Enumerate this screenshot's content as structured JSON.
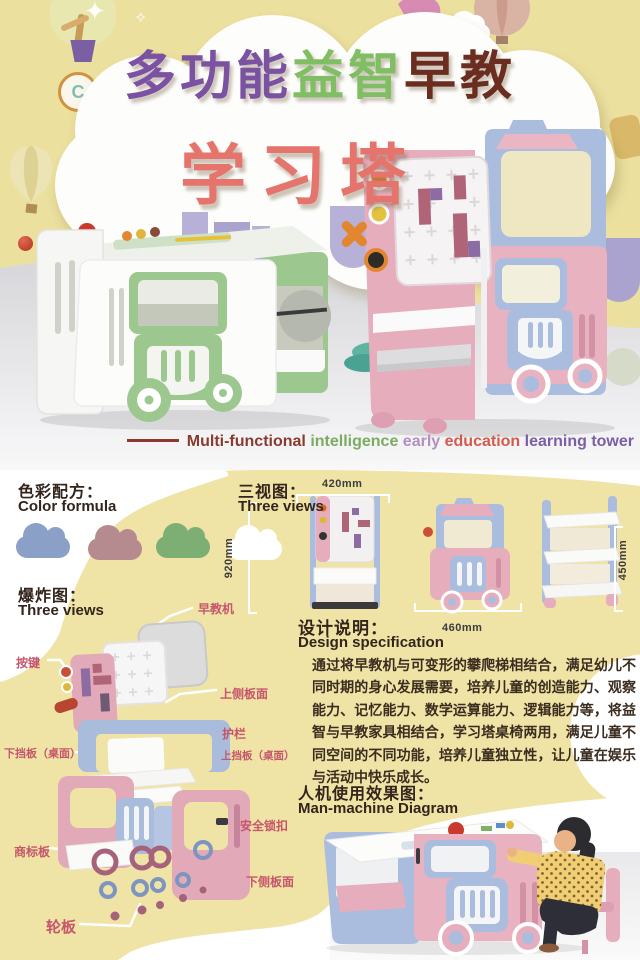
{
  "poster": {
    "title": {
      "seg1": "多功能",
      "seg2": "益智",
      "seg3": "早教",
      "line2": "学习塔"
    },
    "subtitle": {
      "seg1": "Multi-functional",
      "seg2": "intelligence",
      "seg3": "early",
      "seg4": "education",
      "seg5": "learning tower"
    },
    "badges": {
      "c": "C",
      "r": "R"
    }
  },
  "color_formula": {
    "heading_zh": "色彩配方：",
    "heading_en": "Color formula",
    "swatches": [
      {
        "name": "cloud-blue",
        "hex": "#8ba0c6"
      },
      {
        "name": "cloud-mauve",
        "hex": "#b68b90"
      },
      {
        "name": "cloud-green",
        "hex": "#7daf74"
      },
      {
        "name": "cloud-white",
        "hex": "#ffffff"
      }
    ]
  },
  "three_views": {
    "heading_zh": "三视图：",
    "heading_en": "Three views",
    "dim_front_width": "420mm",
    "dim_front_height": "920mm",
    "dim_side_width": "460mm",
    "dim_back_height": "450mm"
  },
  "exploded": {
    "heading_zh": "爆炸图：",
    "heading_en": "Three views",
    "labels": {
      "jiaoyuji": "早教机",
      "anjian": "按键",
      "shang_ce": "上侧板面",
      "hulan": "护栏",
      "shang_dang": "上挡板（桌面）",
      "xia_dang": "下挡板（桌面）",
      "suokou": "安全锁扣",
      "shangbiao": "商标板",
      "xia_ce": "下侧板面",
      "lunban": "轮板"
    }
  },
  "design_spec": {
    "heading_zh": "设计说明：",
    "heading_en": "Design specification",
    "body": "通过将早教机与可变形的攀爬梯相结合，满足幼儿不同时期的身心发展需要，培养儿童的创造能力、观察能力、记忆能力、数学运算能力、逻辑能力等，将益智与早教家具相结合，学习塔桌椅两用，满足儿童不同空间的不同功能，培养儿童独立性，让儿童在娱乐与活动中快乐成长。"
  },
  "man_machine": {
    "heading_zh": "人机使用效果图：",
    "heading_en": "Man-machine Diagram"
  },
  "colors": {
    "background_yellow": "#ece09f",
    "panel_yellow": "#efe3a6",
    "cloud_white": "#fdfdfb",
    "floor_gray": "#dcdcdf",
    "title_purple": "#7b51a1",
    "title_green": "#7fbe62",
    "title_brown": "#6a2d1f",
    "title_salmon": "#e4746c",
    "label_rose": "#c5566b",
    "text_dark": "#3b2c20",
    "product_pink": "#e8b2c0",
    "product_blue": "#aabdde",
    "product_green": "#9cc78f"
  }
}
